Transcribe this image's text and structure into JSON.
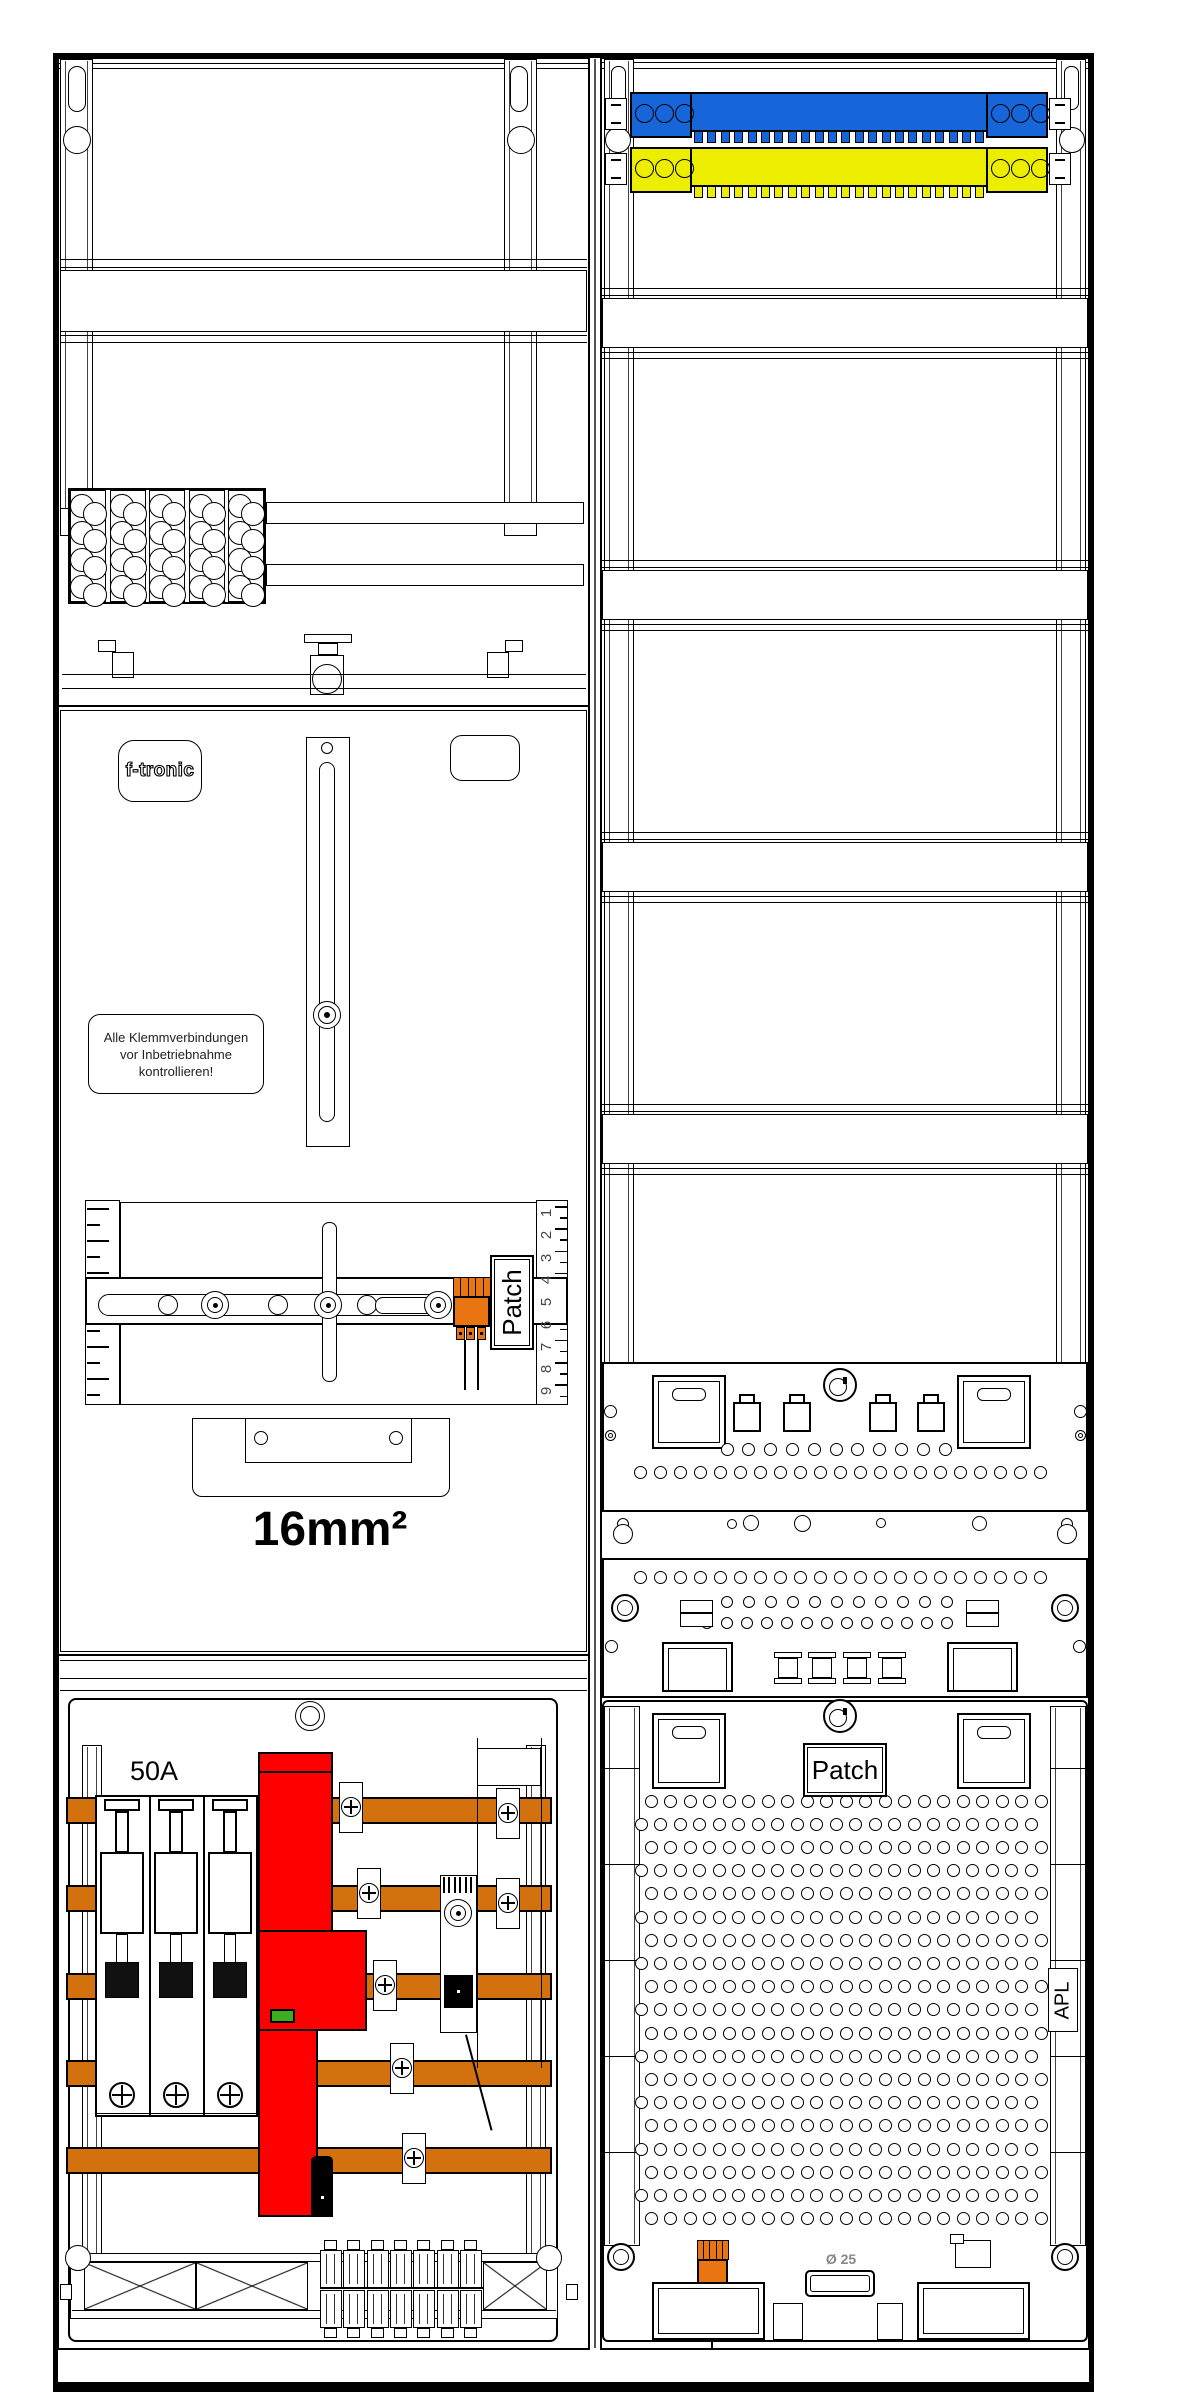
{
  "labels": {
    "brand": "f-tronic",
    "warning_lines": [
      "Alle Klemmverbindungen",
      "vor Inbetriebnahme",
      "kontrollieren!"
    ],
    "wire_cross_section": "16mm²",
    "patch_left": "Patch",
    "patch_right": "Patch",
    "breaker_rating": "50A",
    "apl": "APL",
    "grommet_diameter": "Ø 25",
    "meter_scale_numbers": [
      "1",
      "2",
      "3",
      "4",
      "5",
      "6",
      "7",
      "8",
      "9"
    ]
  },
  "colors": {
    "busbar_copper": "#D2710E",
    "neutral_bar_blue": "#1666D9",
    "pe_bar_yellow": "#EDED00",
    "sls_red": "#FF0000",
    "indicator_green": "#3FAE1C",
    "connector_orange": "#E87511",
    "line_black": "#000000"
  }
}
